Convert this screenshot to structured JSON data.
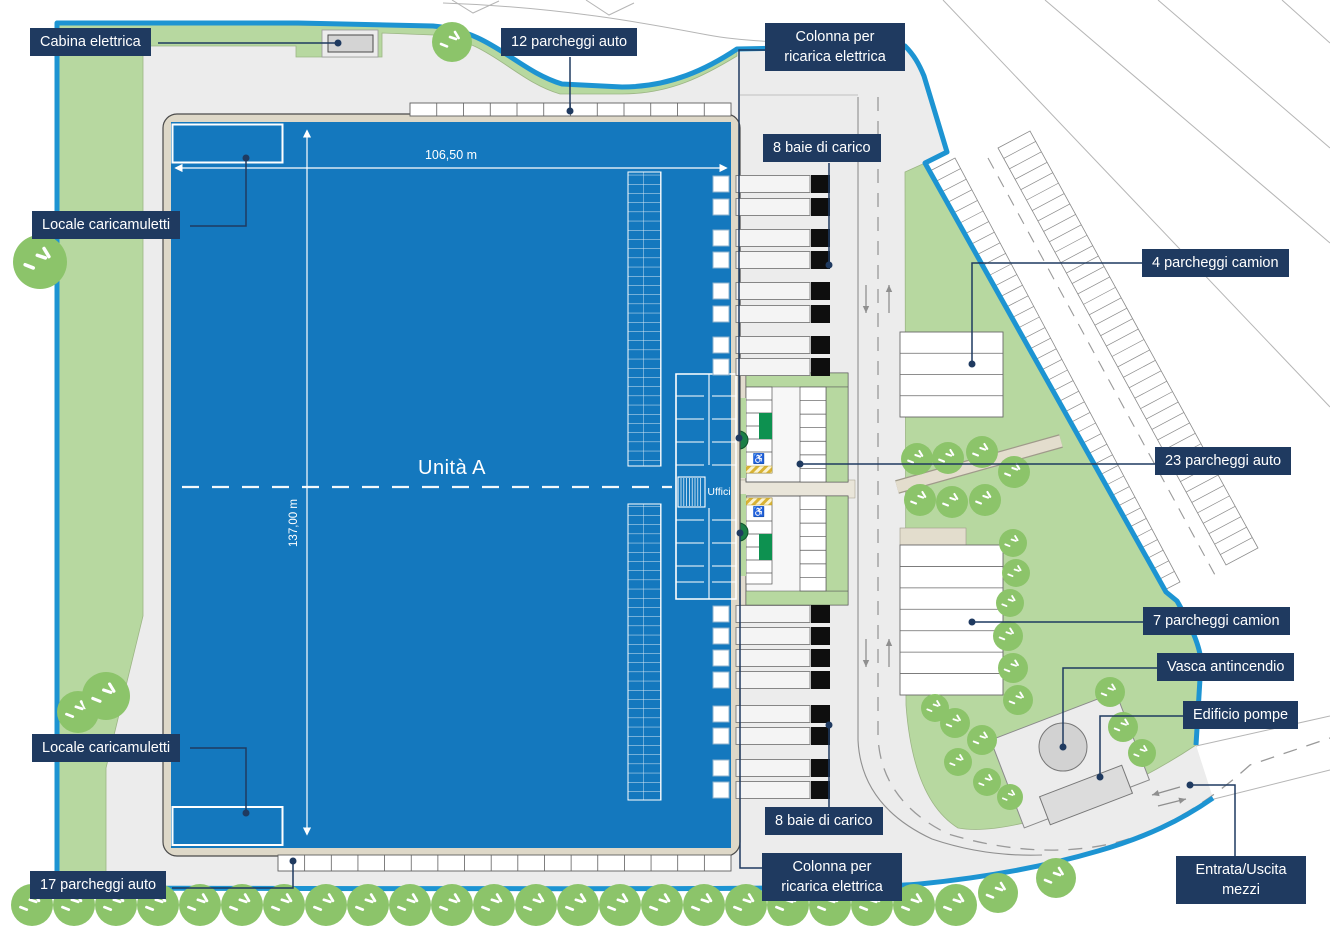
{
  "plan": {
    "building": {
      "name": "Unità A",
      "office": "Uffici",
      "width_dim": "106,50 m",
      "length_dim": "137,00 m"
    },
    "labels": {
      "cabina": "Cabina elettrica",
      "parcheggi12": "12 parcheggi auto",
      "colonnaTop": "Colonna per ricarica elettrica",
      "baieTop": "8 baie di carico",
      "camion4": "4 parcheggi camion",
      "localeTop": "Locale caricamuletti",
      "parcheggi23": "23 parcheggi auto",
      "camion7": "7 parcheggi camion",
      "vasca": "Vasca antincendio",
      "pompe": "Edificio pompe",
      "localeBottom": "Locale caricamuletti",
      "baieBottom": "8 baie di carico",
      "colonnaBottom": "Colonna per ricarica elettrica",
      "parcheggi17": "17 parcheggi auto",
      "entrata": "Entrata/Uscita mezzi"
    },
    "icons": {
      "disabled_parking": "♿"
    },
    "colors": {
      "label_bg": "#1f3a60",
      "building_blue": "#1478be",
      "boundary_blue": "#1d94d2",
      "green": "#b7d8a0",
      "tree_green": "#8cc46a",
      "charge_green": "#0d9150",
      "pavement": "#ececec",
      "wall_beige": "#ded8c8"
    }
  }
}
